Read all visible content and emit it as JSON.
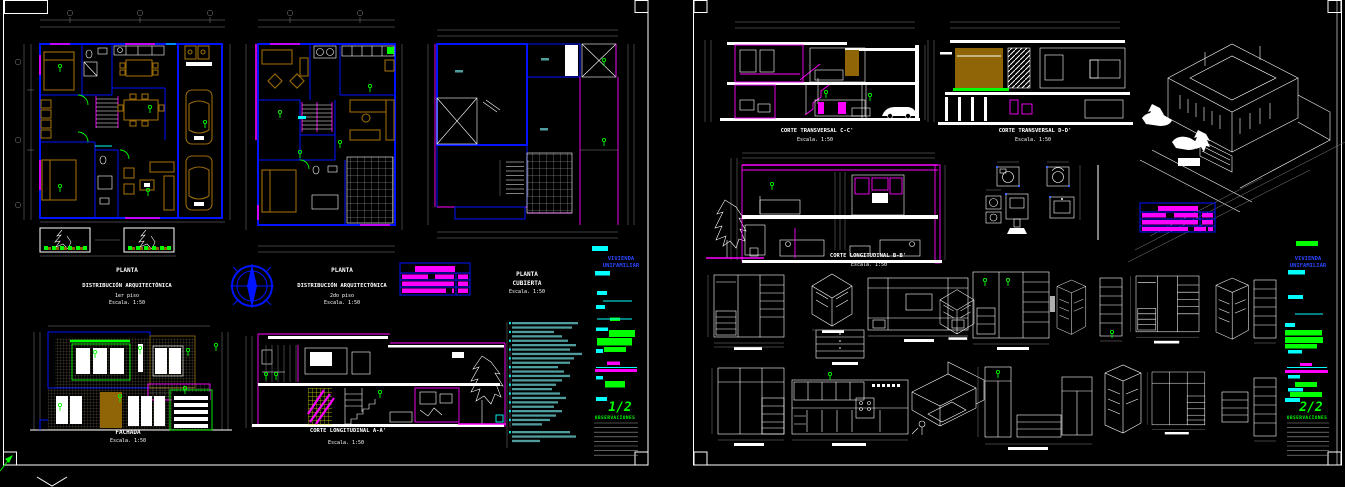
{
  "colors": {
    "background": "#000000",
    "wall_blue": "#0014FF",
    "magenta": "#FF00FF",
    "cyan": "#00FFFF",
    "green": "#00FF00",
    "furniture_brown": "#8F6508",
    "dimension_gray": "#828282",
    "notes_teal": "#4F9C9C",
    "white": "#FFFFFF"
  },
  "left_sheet": {
    "sheet_number": "1/2",
    "project_line1": "VIVIENDA",
    "project_line2": "UNIFAMILIAR",
    "observations_label": "OBSERVACIONES",
    "plan1": {
      "l1": "PLANTA",
      "l2": "DISTRIBUCIÓN ARQUITECTÓNICA",
      "l3": "1er piso",
      "l4": "Escala. 1:50"
    },
    "plan2": {
      "l1": "PLANTA",
      "l2": "DISTRIBUCIÓN ARQUITECTÓNICA",
      "l3": "2do piso",
      "l4": "Escala. 1:50"
    },
    "roof": {
      "l1": "PLANTA",
      "l2": "CUBIERTA",
      "l3": "Escala. 1:50"
    },
    "facade": {
      "l1": "FACHADA",
      "l2": "Escala. 1:50"
    },
    "section_a": {
      "l1": "CORTE LONGITUDINAL A-A'",
      "l2": "Escala. 1:50"
    }
  },
  "right_sheet": {
    "sheet_number": "2/2",
    "project_line1": "VIVIENDA",
    "project_line2": "UNIFAMILIAR",
    "observations_label": "OBSERVACIONES",
    "section_c": {
      "l1": "CORTE TRANSVERSAL C-C'",
      "l2": "Escala. 1:50"
    },
    "section_d": {
      "l1": "CORTE TRANSVERSAL D-D'",
      "l2": "Escala. 1:50"
    },
    "section_b": {
      "l1": "CORTE LONGITUDINAL B-B'",
      "l2": "Escala. 1:50"
    }
  }
}
